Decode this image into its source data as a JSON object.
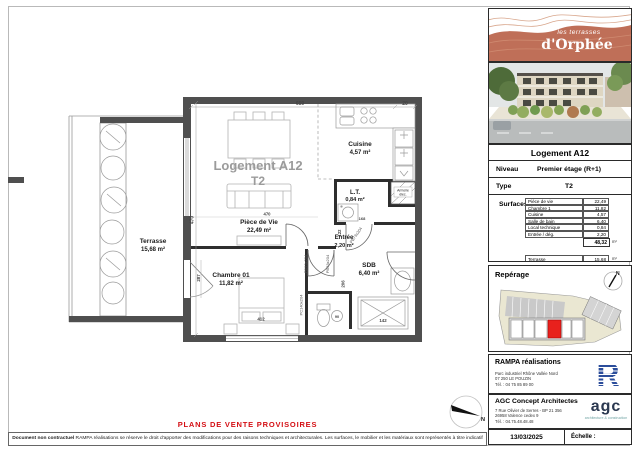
{
  "notice": {
    "title": "PLANS DE VENTE PROVISOIRES",
    "disclaimer_lead": "Document non contractuel",
    "disclaimer_text": " RAMPA réalisations se réserve le droit d'apporter des modifications pour des raisons techniques et architecturales. Les surfaces, le mobilier et les matériaux sont représentés à titre indicatif"
  },
  "watermark": {
    "line1": "Logement A12",
    "line2": "T2"
  },
  "rooms": {
    "terrasse": {
      "name": "Terrasse",
      "area": "15,68 m²"
    },
    "piece_de_vie": {
      "name": "Pièce de Vie",
      "area": "22,49 m²"
    },
    "cuisine": {
      "name": "Cuisine",
      "area": "4,57 m²"
    },
    "lt": {
      "name": "L.T.",
      "area": "0,84 m²"
    },
    "entree": {
      "name": "Entrée",
      "area": "2,20 m²"
    },
    "sdb": {
      "name": "SDB",
      "area": "6,40 m²"
    },
    "chambre": {
      "name": "Chambre 01",
      "area": "11,82 m²"
    }
  },
  "dims": {
    "top": "659",
    "top_right": "20",
    "height": "470",
    "living": "470",
    "terrace_door": "287",
    "bed": "412",
    "sdb": "206",
    "hall": "122",
    "small": "168",
    "wc": "90",
    "shower": "142"
  },
  "tags": {
    "door_chambre": "PB93x204",
    "door_sdb": "PB93x204",
    "bay_chambre": "PC140x204",
    "door_lt": "PB73x204",
    "armoire1": "Armoire",
    "armoire2": "élec."
  },
  "compass": {
    "n": "N"
  },
  "brand": {
    "line1": "les terrasses",
    "line2": "d'Orphée"
  },
  "info": {
    "title": "Logement A12",
    "niveau_label": "Niveau",
    "niveau_value": "Premier étage (R+1)",
    "type_label": "Type",
    "type_value": "T2",
    "surfaces_label": "Surfaces",
    "rows": [
      {
        "label": "Pièce de vie",
        "value": "22,49"
      },
      {
        "label": "Chambre 1",
        "value": "11,82"
      },
      {
        "label": "Cuisine",
        "value": "4,57"
      },
      {
        "label": "Salle de bain",
        "value": "6,40"
      },
      {
        "label": "Local technique",
        "value": "0,84"
      },
      {
        "label": "Entrée / dég.",
        "value": "2,20"
      }
    ],
    "total_value": "48,32",
    "total_unit": "m²",
    "terrasse_label": "Terrasse",
    "terrasse_value": "15,68",
    "terrasse_unit": "m²"
  },
  "reperage": {
    "title": "Repérage",
    "north": "N"
  },
  "rampa": {
    "name": "RAMPA réalisations",
    "address1": "Parc industriel Rhône Vallée Nord",
    "address2": "07 250 LE POUZIN",
    "address3": "Tél. : 04 75 85 89 00",
    "logo_letter": "R"
  },
  "agc": {
    "name": "AGC Concept Architectes",
    "address1": "7 Rue Olivier de Serres - BP 21 356",
    "address2": "26958 Valence cedex 9",
    "address3": "Tél. : 04.75.48.48.48",
    "logo_text": "agc",
    "tagline": "architecture & construction"
  },
  "footer": {
    "date": "13/03/2025",
    "echelle_label": "Échelle :"
  }
}
